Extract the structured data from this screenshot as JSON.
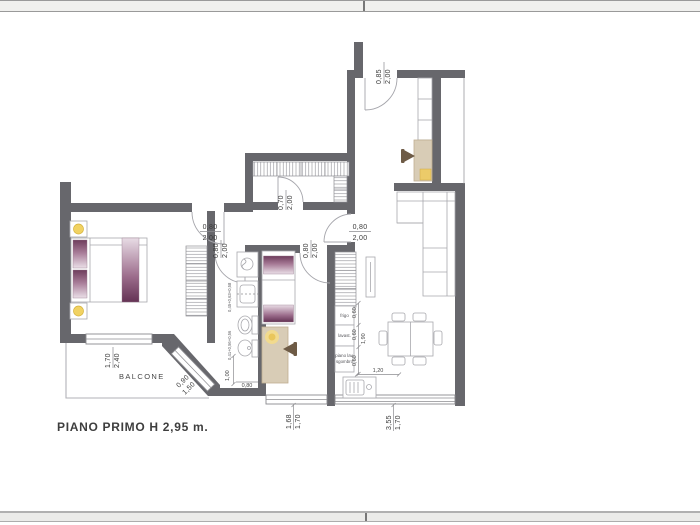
{
  "page": {
    "title": "PIANO PRIMO H 2,95 m.",
    "balcony_label": "BALCONE"
  },
  "kitchen": {
    "fridge_label": "frigo",
    "dishwasher_label": "lavast.",
    "worktop_label_1": "piano lav.",
    "worktop_label_2": "sgombro"
  },
  "dims": {
    "entrance_door": {
      "w": "0,85",
      "h": "2,00"
    },
    "closet_door": {
      "w": "0,70",
      "h": "2,00"
    },
    "bedroom1_door": {
      "w": "0,80",
      "h": "2,00"
    },
    "bathroom_door": {
      "w": "0,80",
      "h": "2,00"
    },
    "bedroom2_door": {
      "w": "0,80",
      "h": "2,00"
    },
    "living_door": {
      "w": "0,80",
      "h": "2,00"
    },
    "bedroom1_window": {
      "w": "1,70",
      "h": "2,40"
    },
    "balcony_window": {
      "w": "0,90",
      "h": "1,50"
    },
    "bedroom2_window": {
      "w": "1,68",
      "h": "1,70"
    },
    "living_window": {
      "w": "3,55",
      "h": "1,70"
    },
    "kitchen_run": "1,20",
    "kitchen_module_1": "0,60",
    "kitchen_module_2": "0,60",
    "kitchen_module_3": "0,60",
    "kitchen_total": "1,90",
    "bath_fixtures_top": "0,45+0,63+0,58",
    "bath_fixtures_bottom": "0,41+0,56+0,56",
    "bath_clearance": "1,00",
    "bath_door_width": "0,80"
  },
  "colors": {
    "wall": "#67676c",
    "accent_purple_dark": "#6e3c5c",
    "accent_purple_light": "#eadfe7",
    "accent_beige": "#d8ccb6",
    "lamp_yellow": "#f1d262"
  }
}
